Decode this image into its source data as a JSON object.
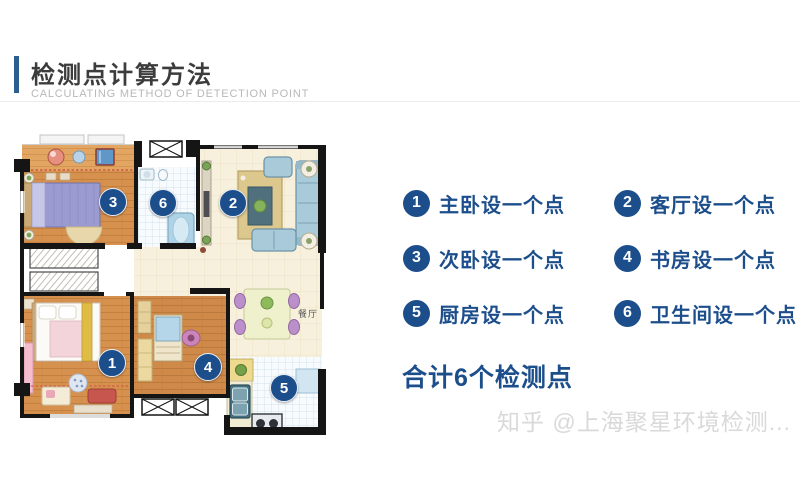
{
  "header": {
    "title": "检测点计算方法",
    "subtitle": "CALCULATING METHOD OF DETECTION POINT"
  },
  "colors": {
    "accent_navy": "#1c4e8c",
    "accent_bar_blue": "#2c5f90",
    "title_dark": "#3c3c3c",
    "subtitle_gray": "#b8b8b8",
    "watermark_gray": "#d9d9d9"
  },
  "floorplan": {
    "room_label_dining": "餐厅",
    "markers": [
      {
        "number": "1",
        "room": "主卧",
        "x": 100,
        "y": 232
      },
      {
        "number": "2",
        "room": "客厅",
        "x": 221,
        "y": 72
      },
      {
        "number": "3",
        "room": "次卧",
        "x": 101,
        "y": 71
      },
      {
        "number": "4",
        "room": "书房",
        "x": 196,
        "y": 236
      },
      {
        "number": "5",
        "room": "厨房",
        "x": 272,
        "y": 257
      },
      {
        "number": "6",
        "room": "卫生间",
        "x": 151,
        "y": 72
      }
    ]
  },
  "legend": {
    "items": [
      {
        "number": "1",
        "label": "主卧设一个点"
      },
      {
        "number": "2",
        "label": "客厅设一个点"
      },
      {
        "number": "3",
        "label": "次卧设一个点"
      },
      {
        "number": "4",
        "label": "书房设一个点"
      },
      {
        "number": "5",
        "label": "厨房设一个点"
      },
      {
        "number": "6",
        "label": "卫生间设一个点"
      }
    ],
    "total": "合计6个检测点"
  },
  "watermark": "知乎 @上海聚星环境检测..."
}
